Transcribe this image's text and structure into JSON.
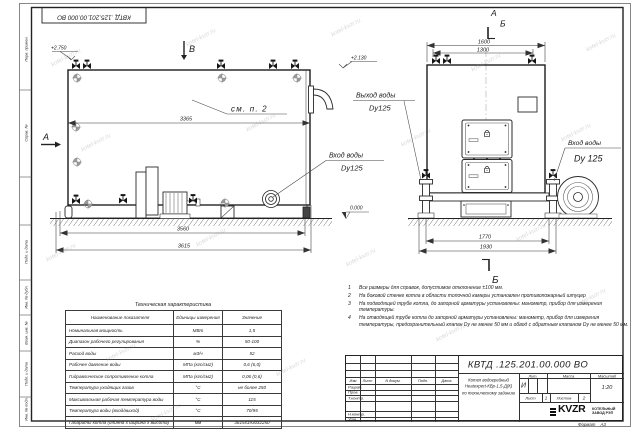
{
  "watermark": "kotel-kvzr.ru",
  "frame_labels": [
    "Перв. примен.",
    "Справ. №",
    "Подп. и дата",
    "Инв. № дубл.",
    "Взам. инв. №",
    "Подп. и дата",
    "Инв. № подл."
  ],
  "drawing": {
    "side_view": {
      "view_b": "В",
      "section_a": "А",
      "elev_top": "+2.750",
      "elev_outlet": "+2.130",
      "see_note": "см. п. 2",
      "dim_top": "3365",
      "dim_base": "3560",
      "dim_overall": "3615",
      "inlet_label": "Вход воды",
      "inlet_dn": "Dy125",
      "outlet_label": "Выход воды",
      "outlet_dn": "Dy125"
    },
    "front_view": {
      "section_a": "А",
      "section_b": "Б",
      "section_b_bottom": "Б",
      "dim_top_outer": "1600",
      "dim_top_inner": "1300",
      "dim_base_inner": "1770",
      "dim_base_outer": "1930",
      "inlet_label": "Вход воды",
      "inlet_dn": "Dy 125",
      "elev_zero": "0.000"
    }
  },
  "notes": [
    {
      "num": "1",
      "text": "Все размеры для справок, допустимое отклонение ±100 мм."
    },
    {
      "num": "2",
      "text": "На боковой стенке котла в области топочной камеры установлен противопожарный штуцер"
    },
    {
      "num": "3",
      "text": "На подводящей трубе котла, до запорной арматуры установлены: манометр, прибор для измерения температуры."
    },
    {
      "num": "4",
      "text": "На отводящей трубе котла до запорной арматуры установлены: манометр, прибор для измерения температуры, предохранительный клапан Dу не менее 50 мм и обвод с обратным клапаном Dу не менее 50 мм."
    }
  ],
  "table": {
    "title": "Техническая характеристика",
    "headers": {
      "name": "Наименование показателя",
      "unit": "Единицы измерения",
      "value": "Значение"
    },
    "rows": [
      {
        "name": "Номинальная мощность",
        "unit": "МВт",
        "value": "1,5"
      },
      {
        "name": "Диапазон рабочего регулирования",
        "unit": "%",
        "value": "50-100"
      },
      {
        "name": "Расход воды",
        "unit": "м3/ч",
        "value": "52"
      },
      {
        "name": "Рабочее давление воды",
        "unit": "МПа (кгс/см2)",
        "value": "0,6 (6,0)"
      },
      {
        "name": "Гидравлическое сопротивление котла",
        "unit": "МПа (кгс/см2)",
        "value": "0,06 (0,6)"
      },
      {
        "name": "Температура уходящих газов",
        "unit": "°С",
        "value": "не более 250"
      },
      {
        "name": "Максимальная рабочая температура воды",
        "unit": "°С",
        "value": "115"
      },
      {
        "name": "Температура воды (вход/выход)",
        "unit": "°С",
        "value": "70/95"
      },
      {
        "name": "Габариты котла (длинна х ширина х высота)",
        "unit": "мм",
        "value": "3615х1930х2250"
      }
    ]
  },
  "titleblock": {
    "doc_number": "КВТД .125.201.00.000  ВО",
    "rev_header": [
      "Изм",
      "Лист",
      "N докум.",
      "Подп.",
      "Дата"
    ],
    "roles": [
      "Разраб.",
      "Пров.",
      "Т.контр.",
      "",
      "Н.контр.",
      "Утв."
    ],
    "title_lines": [
      "Котел водогрейный",
      "Heatexpert-КВр-1,5-Д(К)",
      "по техническому заданию"
    ],
    "lit_header": "Лит.",
    "mass_header": "Масса",
    "scale_header": "Масштаб",
    "lit_value": "И",
    "scale_value": "1:20",
    "sheet_label": "Лист",
    "sheet_value": "1",
    "sheets_label": "Листов",
    "sheets_value": "2",
    "logo_text": "KVZR",
    "logo_sub1": "КОТЕЛЬНЫЙ",
    "logo_sub2": "ЗАВОД РЭП",
    "format_label": "Формат",
    "format_value": "А3"
  }
}
